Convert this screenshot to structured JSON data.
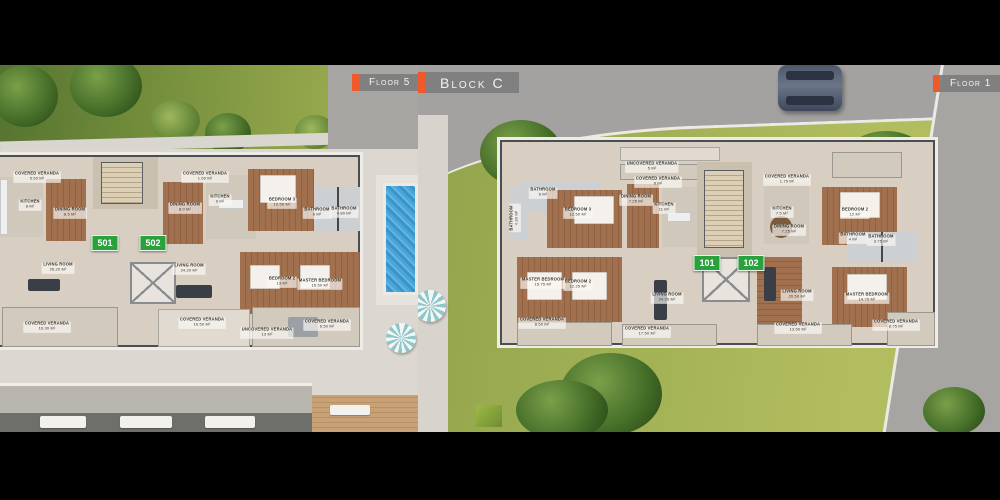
{
  "scene": {
    "description": "Two aerial 3D architectural floor-plan renders side by side with black letterbox bars",
    "colors": {
      "letterbox": "#000000",
      "accent_orange": "#f1582a",
      "tag_gray": "#7d7d7d",
      "tag_text": "#f2f2f2",
      "badge_green": "#2aa13c",
      "pool_blue": "#4aa6d9",
      "lawn_green": "#a3b155",
      "grass_dark": "#47702a",
      "road_gray": "#a3a2a0",
      "plaza": "#dcd8d1",
      "tile_floor": "#d8cfc2",
      "wood_floor": "#9a6e4e",
      "wall_dark": "#43474c"
    }
  },
  "tags": {
    "floor_left": {
      "label": "Floor 5"
    },
    "block": {
      "label": "Block C"
    },
    "floor_right": {
      "label": "Floor 1"
    }
  },
  "left_plan": {
    "floor": "Floor 5",
    "units": [
      {
        "number": "501",
        "x": 105,
        "y": 178
      },
      {
        "number": "502",
        "x": 153,
        "y": 178
      }
    ],
    "rooms": [
      {
        "label": "COVERED VERANDA",
        "area": "5.50 m²",
        "x": 37,
        "y": 112
      },
      {
        "label": "KITCHEN",
        "area": "8 m²",
        "x": 30,
        "y": 140
      },
      {
        "label": "DINING ROOM",
        "area": "8.5 m²",
        "x": 70,
        "y": 148
      },
      {
        "label": "LIVING ROOM",
        "area": "26.20 m²",
        "x": 58,
        "y": 203
      },
      {
        "label": "COVERED VERANDA",
        "area": "16.30 m²",
        "x": 47,
        "y": 262
      },
      {
        "label": "COVERED VERANDA",
        "area": "1.50 m²",
        "x": 205,
        "y": 112
      },
      {
        "label": "KITCHEN",
        "area": "9 m²",
        "x": 220,
        "y": 135
      },
      {
        "label": "DINING ROOM",
        "area": "8.0 m²",
        "x": 185,
        "y": 143
      },
      {
        "label": "BEDROOM 3",
        "area": "12.50 m²",
        "x": 282,
        "y": 138
      },
      {
        "label": "BATHROOM",
        "area": "6 m²",
        "x": 317,
        "y": 148
      },
      {
        "label": "BATHROOM",
        "area": "4.80 m²",
        "x": 344,
        "y": 147
      },
      {
        "label": "BEDROOM 2",
        "area": "13 m²",
        "x": 282,
        "y": 217
      },
      {
        "label": "MASTER BEDROOM",
        "area": "16.50 m²",
        "x": 320,
        "y": 219
      },
      {
        "label": "LIVING ROOM",
        "area": "24.20 m²",
        "x": 189,
        "y": 204
      },
      {
        "label": "COVERED VERANDA",
        "area": "16.50 m²",
        "x": 202,
        "y": 258
      },
      {
        "label": "UNCOVERED VERANDA",
        "area": "13 m²",
        "x": 267,
        "y": 268
      },
      {
        "label": "COVERED VERANDA",
        "area": "6.50 m²",
        "x": 327,
        "y": 260
      }
    ]
  },
  "right_plan": {
    "floor": "Floor 1",
    "block": "Block C",
    "units": [
      {
        "number": "101",
        "x": 289,
        "y": 198
      },
      {
        "number": "102",
        "x": 333,
        "y": 198
      }
    ],
    "rooms": [
      {
        "label": "UNCOVERED VERANDA",
        "area": "5 m²",
        "x": 234,
        "y": 102
      },
      {
        "label": "COVERED VERANDA",
        "area": "8 m²",
        "x": 240,
        "y": 117
      },
      {
        "label": "BATHROOM",
        "area": "6 m²",
        "x": 125,
        "y": 128
      },
      {
        "label": "BATHROOM",
        "area": "4.30 m²",
        "x": 97,
        "y": 153,
        "rot": 90
      },
      {
        "label": "BEDROOM 3",
        "area": "12.50 m²",
        "x": 160,
        "y": 148
      },
      {
        "label": "DINING ROOM",
        "area": "7.25 m²",
        "x": 218,
        "y": 135
      },
      {
        "label": "KITCHEN",
        "area": "11 m²",
        "x": 246,
        "y": 143
      },
      {
        "label": "MASTER BEDROOM",
        "area": "15.75 m²",
        "x": 125,
        "y": 218
      },
      {
        "label": "BEDROOM 2",
        "area": "12.25 m²",
        "x": 160,
        "y": 220
      },
      {
        "label": "LIVING ROOM",
        "area": "24.25 m²",
        "x": 249,
        "y": 233
      },
      {
        "label": "COVERED VERANDA",
        "area": "8.50 m²",
        "x": 124,
        "y": 258
      },
      {
        "label": "COVERED VERANDA",
        "area": "17.50 m²",
        "x": 229,
        "y": 267
      },
      {
        "label": "COVERED VERANDA",
        "area": "1.75 m²",
        "x": 369,
        "y": 115
      },
      {
        "label": "KITCHEN",
        "area": "7.5 m²",
        "x": 364,
        "y": 147
      },
      {
        "label": "DINING ROOM",
        "area": "7.25 m²",
        "x": 371,
        "y": 165
      },
      {
        "label": "BEDROOM 2",
        "area": "12 m²",
        "x": 437,
        "y": 148
      },
      {
        "label": "BATHROOM",
        "area": "4 m²",
        "x": 435,
        "y": 173
      },
      {
        "label": "BATHROOM",
        "area": "3.75 m²",
        "x": 463,
        "y": 175
      },
      {
        "label": "MASTER BEDROOM",
        "area": "14.75 m²",
        "x": 449,
        "y": 233
      },
      {
        "label": "LIVING ROOM",
        "area": "20.50 m²",
        "x": 379,
        "y": 230
      },
      {
        "label": "COVERED VERANDA",
        "area": "13.50 m²",
        "x": 380,
        "y": 263
      },
      {
        "label": "COVERED VERANDA",
        "area": "8.75 m²",
        "x": 478,
        "y": 260
      }
    ]
  }
}
